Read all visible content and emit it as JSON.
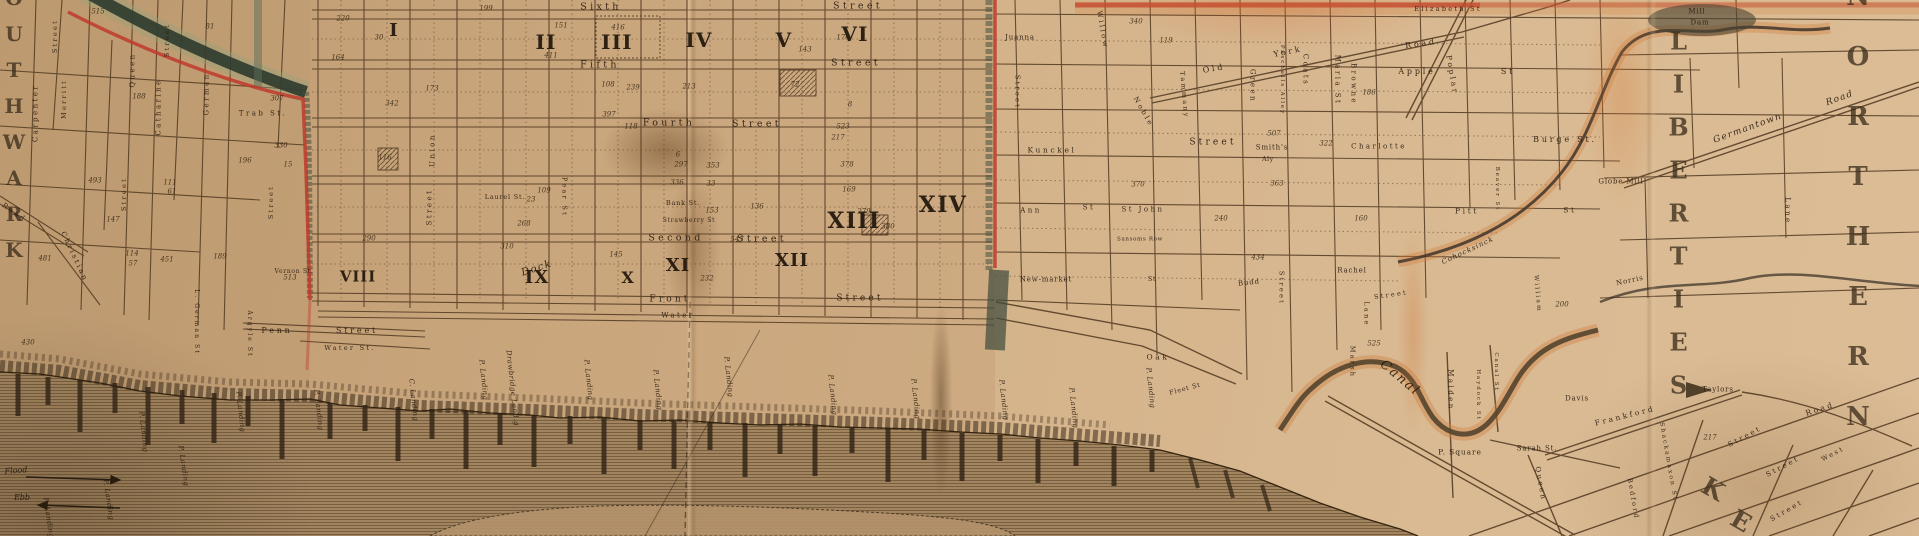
{
  "districts": [
    {
      "t": "SOUTHWARK",
      "x": 14,
      "y": 112,
      "s": 20,
      "ls": 12,
      "vert": true
    },
    {
      "t": "NORTHERN",
      "x": 1858,
      "y": 222,
      "s": 26,
      "ls": 30,
      "vert": true
    },
    {
      "t": "LIBERTIES",
      "x": 1678,
      "y": 220,
      "s": 24,
      "ls": 14,
      "vert": true
    },
    {
      "t": "K",
      "x": 1713,
      "y": 489,
      "r": 30,
      "s": 25
    },
    {
      "t": "E",
      "x": 1741,
      "y": 521,
      "r": 30,
      "s": 25
    }
  ],
  "wards": [
    {
      "numeral": "I",
      "x": 394,
      "y": 31,
      "s": 18
    },
    {
      "numeral": "II",
      "x": 546,
      "y": 42,
      "s": 20
    },
    {
      "numeral": "III",
      "x": 617,
      "y": 42,
      "s": 20
    },
    {
      "numeral": "IV",
      "x": 699,
      "y": 40,
      "s": 20
    },
    {
      "numeral": "V",
      "x": 784,
      "y": 40,
      "s": 20
    },
    {
      "numeral": "VI",
      "x": 855,
      "y": 34,
      "s": 20
    },
    {
      "numeral": "VIII",
      "x": 358,
      "y": 277,
      "s": 15
    },
    {
      "numeral": "IX",
      "x": 537,
      "y": 278,
      "s": 18
    },
    {
      "numeral": "X",
      "x": 628,
      "y": 278,
      "s": 16
    },
    {
      "numeral": "XI",
      "x": 678,
      "y": 266,
      "s": 18
    },
    {
      "numeral": "XII",
      "x": 792,
      "y": 261,
      "s": 18
    },
    {
      "numeral": "XIII",
      "x": 854,
      "y": 221,
      "s": 22
    },
    {
      "numeral": "XIV",
      "x": 943,
      "y": 205,
      "s": 22
    }
  ],
  "streets": [
    {
      "t": "Sixth",
      "x": 601,
      "y": 7,
      "r": 0,
      "s": 9.5
    },
    {
      "t": "Street",
      "x": 858,
      "y": 6,
      "r": 0,
      "s": 9.5
    },
    {
      "t": "Fifth",
      "x": 600,
      "y": 65,
      "r": 0,
      "s": 9.5
    },
    {
      "t": "Street",
      "x": 856,
      "y": 63,
      "r": 0,
      "s": 9.5
    },
    {
      "t": "Fourth",
      "x": 669,
      "y": 123,
      "r": 0,
      "s": 9.5
    },
    {
      "t": "Street",
      "x": 757,
      "y": 124,
      "r": 0,
      "s": 9.5
    },
    {
      "t": "Second",
      "x": 676,
      "y": 238,
      "r": 0,
      "s": 9.5
    },
    {
      "t": "Street",
      "x": 762,
      "y": 239,
      "r": 0,
      "s": 9.5
    },
    {
      "t": "Front",
      "x": 670,
      "y": 300,
      "r": 0,
      "s": 9
    },
    {
      "t": "Street",
      "x": 860,
      "y": 299,
      "r": 0,
      "s": 9
    },
    {
      "t": "Water",
      "x": 678,
      "y": 316,
      "r": 0,
      "s": 7
    },
    {
      "t": "Water St.",
      "x": 350,
      "y": 348,
      "r": 0,
      "s": 6.5
    },
    {
      "t": "Penn",
      "x": 277,
      "y": 331,
      "r": 0,
      "s": 8
    },
    {
      "t": "Street",
      "x": 357,
      "y": 331,
      "r": 0,
      "s": 8
    },
    {
      "t": "Pear St",
      "x": 564,
      "y": 197,
      "r": 90,
      "s": 6.5
    },
    {
      "t": "Union",
      "x": 433,
      "y": 150,
      "r": -90,
      "s": 7
    },
    {
      "t": "Street",
      "x": 430,
      "y": 207,
      "r": -90,
      "s": 7
    },
    {
      "t": "Carpenter",
      "x": 36,
      "y": 113,
      "r": -90,
      "s": 7
    },
    {
      "t": "Street",
      "x": 55,
      "y": 36,
      "r": -90,
      "s": 6.5
    },
    {
      "t": "Merritt",
      "x": 64,
      "y": 99,
      "r": -90,
      "s": 6.5
    },
    {
      "t": "Queen",
      "x": 133,
      "y": 70,
      "r": -90,
      "s": 7
    },
    {
      "t": "Catharine",
      "x": 159,
      "y": 107,
      "r": -90,
      "s": 7
    },
    {
      "t": "German",
      "x": 207,
      "y": 94,
      "r": -90,
      "s": 7
    },
    {
      "t": "Street",
      "x": 167,
      "y": 40,
      "r": -90,
      "s": 6.5
    },
    {
      "t": "Street",
      "x": 124,
      "y": 194,
      "r": -90,
      "s": 6.5
    },
    {
      "t": "Street",
      "x": 271,
      "y": 202,
      "r": -90,
      "s": 6.5
    },
    {
      "t": "Christian",
      "x": 74,
      "y": 257,
      "r": 65,
      "s": 7
    },
    {
      "t": "Trab St.",
      "x": 263,
      "y": 114,
      "r": 0,
      "s": 7
    },
    {
      "t": "Road",
      "x": 14,
      "y": 213,
      "r": 35,
      "s": 7
    },
    {
      "t": "L. German St",
      "x": 196,
      "y": 322,
      "r": 90,
      "s": 6
    },
    {
      "t": "Argyle St",
      "x": 249,
      "y": 334,
      "r": 90,
      "s": 6
    },
    {
      "t": "Street",
      "x": 1017,
      "y": 92,
      "r": 90,
      "s": 6.5
    },
    {
      "t": "Willow",
      "x": 1102,
      "y": 30,
      "r": 80,
      "s": 7
    },
    {
      "t": "Noble",
      "x": 1143,
      "y": 112,
      "r": 60,
      "s": 7
    },
    {
      "t": "Tammany",
      "x": 1184,
      "y": 95,
      "r": 85,
      "s": 6.5
    },
    {
      "t": "Kunckel",
      "x": 1052,
      "y": 150,
      "r": 0,
      "s": 7.5
    },
    {
      "t": "Old",
      "x": 1214,
      "y": 69,
      "r": -10,
      "s": 8
    },
    {
      "t": "York",
      "x": 1288,
      "y": 52,
      "r": -12,
      "s": 8
    },
    {
      "t": "Road",
      "x": 1421,
      "y": 44,
      "r": -8,
      "s": 8
    },
    {
      "t": "Green",
      "x": 1252,
      "y": 86,
      "r": 90,
      "s": 7
    },
    {
      "t": "Paschalls Alley",
      "x": 1281,
      "y": 80,
      "r": 90,
      "s": 5.5
    },
    {
      "t": "Coats",
      "x": 1305,
      "y": 70,
      "r": 90,
      "s": 7
    },
    {
      "t": "Maria St",
      "x": 1337,
      "y": 80,
      "r": 90,
      "s": 7
    },
    {
      "t": "Browne",
      "x": 1353,
      "y": 84,
      "r": 90,
      "s": 7
    },
    {
      "t": "Apple",
      "x": 1417,
      "y": 72,
      "r": 0,
      "s": 8
    },
    {
      "t": "St",
      "x": 1508,
      "y": 72,
      "r": 0,
      "s": 8
    },
    {
      "t": "Poplar",
      "x": 1452,
      "y": 75,
      "r": 80,
      "s": 7.5
    },
    {
      "t": "Burge St.",
      "x": 1565,
      "y": 140,
      "r": 0,
      "s": 8
    },
    {
      "t": "Pitt",
      "x": 1467,
      "y": 211,
      "r": 0,
      "s": 7.5
    },
    {
      "t": "St",
      "x": 1570,
      "y": 210,
      "r": 0,
      "s": 7.5
    },
    {
      "t": "Beaver St",
      "x": 1496,
      "y": 189,
      "r": 90,
      "s": 5.5
    },
    {
      "t": "Maiden",
      "x": 1450,
      "y": 390,
      "r": 90,
      "s": 7
    },
    {
      "t": "Haydock St",
      "x": 1477,
      "y": 395,
      "r": 90,
      "s": 5.5
    },
    {
      "t": "Canal St",
      "x": 1495,
      "y": 372,
      "r": 90,
      "s": 5.5
    },
    {
      "t": "Marsh",
      "x": 1352,
      "y": 362,
      "r": 90,
      "s": 6.5
    },
    {
      "t": "Lane",
      "x": 1366,
      "y": 314,
      "r": 90,
      "s": 6.5
    },
    {
      "t": "Street",
      "x": 1391,
      "y": 295,
      "r": -8,
      "s": 6.5
    },
    {
      "t": "Street",
      "x": 1281,
      "y": 288,
      "r": 90,
      "s": 6.5
    },
    {
      "t": "William",
      "x": 1537,
      "y": 294,
      "r": 85,
      "s": 6
    },
    {
      "t": "Oak",
      "x": 1158,
      "y": 357,
      "r": 0,
      "s": 7.5
    },
    {
      "t": "Street",
      "x": 1213,
      "y": 143,
      "r": 0,
      "s": 9
    },
    {
      "t": "Queen",
      "x": 1540,
      "y": 484,
      "r": 80,
      "s": 7
    },
    {
      "t": "Frankford",
      "x": 1625,
      "y": 416,
      "r": -14,
      "s": 7.5
    },
    {
      "t": "Road",
      "x": 1820,
      "y": 409,
      "r": -18,
      "s": 7.5
    },
    {
      "t": "Street",
      "x": 1745,
      "y": 437,
      "r": -28,
      "s": 7
    },
    {
      "t": "Street",
      "x": 1783,
      "y": 467,
      "r": -28,
      "s": 7
    },
    {
      "t": "Street",
      "x": 1787,
      "y": 511,
      "r": -30,
      "s": 7
    },
    {
      "t": "West",
      "x": 1833,
      "y": 454,
      "r": -28,
      "s": 6.5
    },
    {
      "t": "Shackamaxon St",
      "x": 1668,
      "y": 462,
      "r": 80,
      "s": 6
    },
    {
      "t": "Bedford",
      "x": 1633,
      "y": 499,
      "r": 80,
      "s": 6.5
    },
    {
      "t": "Lane",
      "x": 1787,
      "y": 211,
      "r": 90,
      "s": 7
    },
    {
      "t": "Ann",
      "x": 1031,
      "y": 211,
      "r": 0,
      "s": 7
    },
    {
      "t": "St",
      "x": 1089,
      "y": 208,
      "r": 0,
      "s": 7
    },
    {
      "t": "St John",
      "x": 1143,
      "y": 210,
      "r": 0,
      "s": 7
    },
    {
      "t": "Elizabeth St",
      "x": 1448,
      "y": 9,
      "r": 0,
      "s": 6.5
    },
    {
      "t": "Charlotte",
      "x": 1379,
      "y": 147,
      "r": 0,
      "s": 7
    }
  ],
  "places": [
    {
      "t": "Bank St.",
      "x": 683,
      "y": 203,
      "r": 0,
      "s": 6.5
    },
    {
      "t": "Strawberry St",
      "x": 689,
      "y": 221,
      "r": 0,
      "s": 6
    },
    {
      "t": "Laurel St.",
      "x": 505,
      "y": 197,
      "r": 0,
      "s": 6.5
    },
    {
      "t": "Vernon St.",
      "x": 294,
      "y": 272,
      "r": 0,
      "s": 6
    },
    {
      "t": "Juanna",
      "x": 1020,
      "y": 38,
      "r": 0,
      "s": 7
    },
    {
      "t": "New-market",
      "x": 1046,
      "y": 280,
      "r": 0,
      "s": 7
    },
    {
      "t": "St",
      "x": 1152,
      "y": 279,
      "r": 0,
      "s": 6.5
    },
    {
      "t": "Sansoms Row",
      "x": 1140,
      "y": 240,
      "r": 0,
      "s": 5.5
    },
    {
      "t": "Smith's",
      "x": 1272,
      "y": 148,
      "r": 0,
      "s": 7
    },
    {
      "t": "Aly",
      "x": 1268,
      "y": 160,
      "r": 0,
      "s": 6
    },
    {
      "t": "Rachel",
      "x": 1352,
      "y": 271,
      "r": 0,
      "s": 7
    },
    {
      "t": "Budd",
      "x": 1249,
      "y": 283,
      "r": -6,
      "s": 7
    },
    {
      "t": "Fleet St",
      "x": 1185,
      "y": 389,
      "r": -15,
      "s": 6.5
    },
    {
      "t": "P. Square",
      "x": 1460,
      "y": 452,
      "r": 0,
      "s": 7.5
    },
    {
      "t": "Sarah St.",
      "x": 1537,
      "y": 449,
      "r": 0,
      "s": 7
    },
    {
      "t": "Davis",
      "x": 1577,
      "y": 399,
      "r": 0,
      "s": 7
    },
    {
      "t": "Taylors",
      "x": 1718,
      "y": 390,
      "r": 0,
      "s": 7
    },
    {
      "t": "Norris",
      "x": 1630,
      "y": 281,
      "r": -12,
      "s": 7
    },
    {
      "t": "Globe Mill",
      "x": 1621,
      "y": 182,
      "r": 0,
      "s": 7
    },
    {
      "t": "Mill",
      "x": 1697,
      "y": 12,
      "r": 0,
      "s": 7
    },
    {
      "t": "Dam",
      "x": 1700,
      "y": 23,
      "r": 0,
      "s": 7
    }
  ],
  "scripts": [
    {
      "t": "Dock",
      "x": 537,
      "y": 269,
      "r": -18,
      "s": 10
    },
    {
      "t": "Canal",
      "x": 1400,
      "y": 378,
      "r": 40,
      "s": 13
    },
    {
      "t": "Cohocksinck",
      "x": 1468,
      "y": 251,
      "r": -25,
      "s": 7
    },
    {
      "t": "Germantown",
      "x": 1748,
      "y": 129,
      "r": -20,
      "s": 9
    },
    {
      "t": "Road",
      "x": 1840,
      "y": 99,
      "r": -20,
      "s": 9
    }
  ],
  "landings": [
    {
      "t": "P. Landing",
      "x": 48,
      "y": 518,
      "r": 82
    },
    {
      "t": "P. Landing",
      "x": 108,
      "y": 500,
      "r": 82
    },
    {
      "t": "P. Landing",
      "x": 143,
      "y": 432,
      "r": 84
    },
    {
      "t": "P. Landing",
      "x": 183,
      "y": 466,
      "r": 82
    },
    {
      "t": "P. Landing",
      "x": 240,
      "y": 412,
      "r": 84
    },
    {
      "t": "P. Landing",
      "x": 318,
      "y": 410,
      "r": 84
    },
    {
      "t": "C. Landing",
      "x": 413,
      "y": 400,
      "r": 84
    },
    {
      "t": "P. Landing",
      "x": 483,
      "y": 380,
      "r": 84
    },
    {
      "t": "Drawbridge Land.g",
      "x": 512,
      "y": 388,
      "r": 84
    },
    {
      "t": "P. Landing",
      "x": 588,
      "y": 380,
      "r": 84
    },
    {
      "t": "P. Landing",
      "x": 657,
      "y": 390,
      "r": 84
    },
    {
      "t": "P. Landing",
      "x": 728,
      "y": 377,
      "r": 84
    },
    {
      "t": "P. Landing",
      "x": 832,
      "y": 395,
      "r": 84
    },
    {
      "t": "P. Landing",
      "x": 915,
      "y": 399,
      "r": 84
    },
    {
      "t": "P. Landing",
      "x": 1003,
      "y": 400,
      "r": 84
    },
    {
      "t": "P. Landing",
      "x": 1073,
      "y": 408,
      "r": 84
    },
    {
      "t": "P. Landing",
      "x": 1150,
      "y": 388,
      "r": 84
    }
  ],
  "tide_labels": {
    "flood": "Flood",
    "ebb": "Ebb"
  },
  "numbers": [
    {
      "v": "515",
      "x": 98,
      "y": 12
    },
    {
      "v": "81",
      "x": 210,
      "y": 27
    },
    {
      "v": "188",
      "x": 139,
      "y": 97
    },
    {
      "v": "111",
      "x": 170,
      "y": 183
    },
    {
      "v": "61",
      "x": 172,
      "y": 192
    },
    {
      "v": "147",
      "x": 113,
      "y": 220
    },
    {
      "v": "481",
      "x": 45,
      "y": 259
    },
    {
      "v": "493",
      "x": 95,
      "y": 181
    },
    {
      "v": "114",
      "x": 132,
      "y": 254
    },
    {
      "v": "57",
      "x": 133,
      "y": 264
    },
    {
      "v": "451",
      "x": 167,
      "y": 260
    },
    {
      "v": "189",
      "x": 220,
      "y": 257
    },
    {
      "v": "196",
      "x": 245,
      "y": 161
    },
    {
      "v": "307",
      "x": 277,
      "y": 99
    },
    {
      "v": "330",
      "x": 281,
      "y": 146
    },
    {
      "v": "15",
      "x": 288,
      "y": 165
    },
    {
      "v": "430",
      "x": 28,
      "y": 343
    },
    {
      "v": "513",
      "x": 290,
      "y": 278
    },
    {
      "v": "199",
      "x": 486,
      "y": 9
    },
    {
      "v": "151",
      "x": 561,
      "y": 26
    },
    {
      "v": "411",
      "x": 551,
      "y": 56
    },
    {
      "v": "416",
      "x": 618,
      "y": 28
    },
    {
      "v": "108",
      "x": 608,
      "y": 85
    },
    {
      "v": "239",
      "x": 633,
      "y": 88
    },
    {
      "v": "397",
      "x": 609,
      "y": 115
    },
    {
      "v": "213",
      "x": 689,
      "y": 87
    },
    {
      "v": "173",
      "x": 432,
      "y": 89
    },
    {
      "v": "342",
      "x": 392,
      "y": 104
    },
    {
      "v": "116",
      "x": 385,
      "y": 158
    },
    {
      "v": "290",
      "x": 369,
      "y": 239
    },
    {
      "v": "164",
      "x": 338,
      "y": 58
    },
    {
      "v": "30",
      "x": 379,
      "y": 38
    },
    {
      "v": "220",
      "x": 343,
      "y": 19
    },
    {
      "v": "118",
      "x": 631,
      "y": 127
    },
    {
      "v": "6",
      "x": 678,
      "y": 155
    },
    {
      "v": "297",
      "x": 681,
      "y": 165
    },
    {
      "v": "353",
      "x": 713,
      "y": 166
    },
    {
      "v": "109",
      "x": 544,
      "y": 191
    },
    {
      "v": "23",
      "x": 531,
      "y": 200
    },
    {
      "v": "268",
      "x": 524,
      "y": 224
    },
    {
      "v": "336",
      "x": 677,
      "y": 183
    },
    {
      "v": "33",
      "x": 711,
      "y": 184
    },
    {
      "v": "153",
      "x": 712,
      "y": 211
    },
    {
      "v": "136",
      "x": 757,
      "y": 207
    },
    {
      "v": "547",
      "x": 737,
      "y": 240
    },
    {
      "v": "145",
      "x": 616,
      "y": 255
    },
    {
      "v": "310",
      "x": 507,
      "y": 247
    },
    {
      "v": "232",
      "x": 707,
      "y": 279
    },
    {
      "v": "169",
      "x": 849,
      "y": 190
    },
    {
      "v": "279",
      "x": 864,
      "y": 212
    },
    {
      "v": "380",
      "x": 888,
      "y": 227
    },
    {
      "v": "378",
      "x": 847,
      "y": 165
    },
    {
      "v": "143",
      "x": 805,
      "y": 50
    },
    {
      "v": "176",
      "x": 843,
      "y": 38
    },
    {
      "v": "8",
      "x": 850,
      "y": 105
    },
    {
      "v": "523",
      "x": 843,
      "y": 127
    },
    {
      "v": "217",
      "x": 838,
      "y": 138
    },
    {
      "v": "72",
      "x": 795,
      "y": 85
    },
    {
      "v": "340",
      "x": 1136,
      "y": 22
    },
    {
      "v": "119",
      "x": 1166,
      "y": 41
    },
    {
      "v": "370",
      "x": 1138,
      "y": 185
    },
    {
      "v": "186",
      "x": 1369,
      "y": 93
    },
    {
      "v": "322",
      "x": 1326,
      "y": 144
    },
    {
      "v": "507",
      "x": 1274,
      "y": 134
    },
    {
      "v": "363",
      "x": 1277,
      "y": 184
    },
    {
      "v": "240",
      "x": 1221,
      "y": 219
    },
    {
      "v": "160",
      "x": 1361,
      "y": 219
    },
    {
      "v": "434",
      "x": 1258,
      "y": 258
    },
    {
      "v": "525",
      "x": 1374,
      "y": 344
    },
    {
      "v": "217",
      "x": 1710,
      "y": 438
    },
    {
      "v": "200",
      "x": 1562,
      "y": 305
    }
  ]
}
